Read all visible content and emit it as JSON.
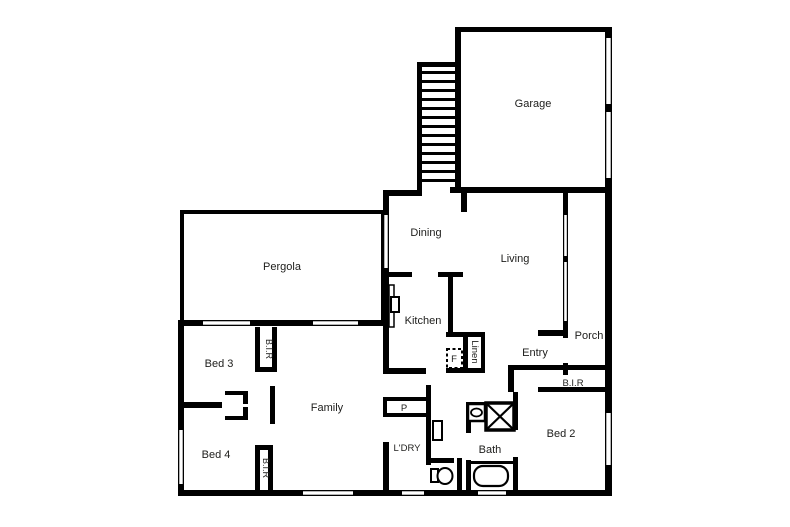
{
  "floorplan": {
    "colors": {
      "wall": "#000000",
      "background": "#ffffff",
      "label": "#1d1d1b"
    },
    "rooms": {
      "garage": "Garage",
      "pergola": "Pergola",
      "dining": "Dining",
      "living": "Living",
      "porch": "Porch",
      "kitchen": "Kitchen",
      "entry": "Entry",
      "family": "Family",
      "bed2": "Bed 2",
      "bed3": "Bed 3",
      "bed4": "Bed 4",
      "bath": "Bath",
      "laundry": "L'DRY"
    },
    "closets": {
      "bed2_bir": "B.I.R",
      "bed3_bir": "B.I.R",
      "bed4_bir": "B.I.R",
      "linen": "Linen"
    },
    "fixtures": {
      "pantry": "P",
      "fridge": "F"
    }
  }
}
